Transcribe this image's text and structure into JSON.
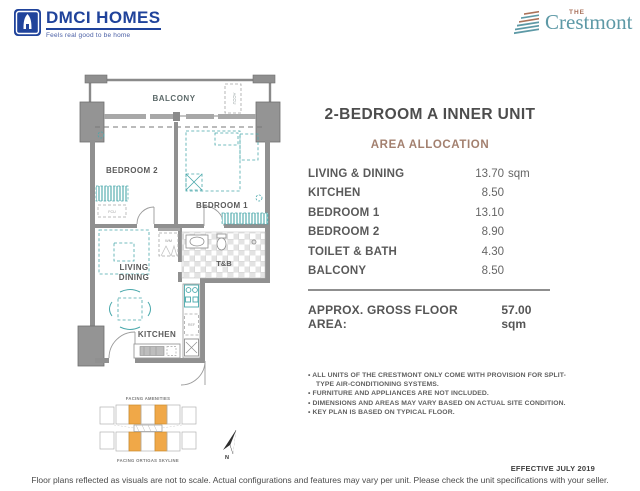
{
  "header": {
    "dmci_brand": "DMCI HOMES",
    "dmci_tagline": "Feels real good to be home",
    "crestmont_the": "THE",
    "crestmont_name": "Crestmont"
  },
  "unit": {
    "title": "2-BEDROOM A INNER UNIT"
  },
  "allocation": {
    "heading": "AREA ALLOCATION",
    "rows": [
      {
        "label": "LIVING & DINING",
        "value": "13.70",
        "suffix": "sqm"
      },
      {
        "label": "KITCHEN",
        "value": "8.50",
        "suffix": ""
      },
      {
        "label": "BEDROOM 1",
        "value": "13.10",
        "suffix": ""
      },
      {
        "label": "BEDROOM 2",
        "value": "8.90",
        "suffix": ""
      },
      {
        "label": "TOILET & BATH",
        "value": "4.30",
        "suffix": ""
      },
      {
        "label": "BALCONY",
        "value": "8.50",
        "suffix": ""
      }
    ]
  },
  "gross": {
    "label": "APPROX. GROSS FLOOR AREA:",
    "value": "57.00 sqm"
  },
  "notes": {
    "items": [
      "ALL UNITS OF THE CRESTMONT ONLY COME WITH PROVISION FOR SPLIT-TYPE AIR-CONDITIONING SYSTEMS.",
      "FURNITURE AND APPLIANCES ARE NOT INCLUDED.",
      "DIMENSIONS AND AREAS MAY VARY BASED ON ACTUAL SITE CONDITION.",
      "KEY PLAN IS BASED ON TYPICAL FLOOR."
    ]
  },
  "effective": "EFFECTIVE JULY 2019",
  "disclaimer": "Floor plans reflected as visuals are not to scale. Actual configurations and features may vary per unit. Please check the unit specifications with your seller.",
  "floorplan": {
    "labels": {
      "balcony": "BALCONY",
      "accu": "ACCU",
      "bedroom2": "BEDROOM 2",
      "bedroom1": "BEDROOM 1",
      "living": "LIVING",
      "dining": "DINING",
      "kitchen": "KITCHEN",
      "tb": "T&B",
      "wm": "WM",
      "ref": "REF",
      "fcu": "FCU"
    }
  },
  "keyplan": {
    "facing_amenities": "FACING AMENITIES",
    "facing_skyline": "FACING ORTIGAS SKYLINE",
    "north": "N"
  },
  "colors": {
    "dmci_blue": "#20439b",
    "crestmont_teal": "#5d99a6",
    "crestmont_rust": "#ab7259",
    "heading_brown": "#a3806f",
    "furniture_teal": "#49a8ab",
    "wall_gray": "#909090",
    "keyplan_orange": "#f0a848"
  }
}
